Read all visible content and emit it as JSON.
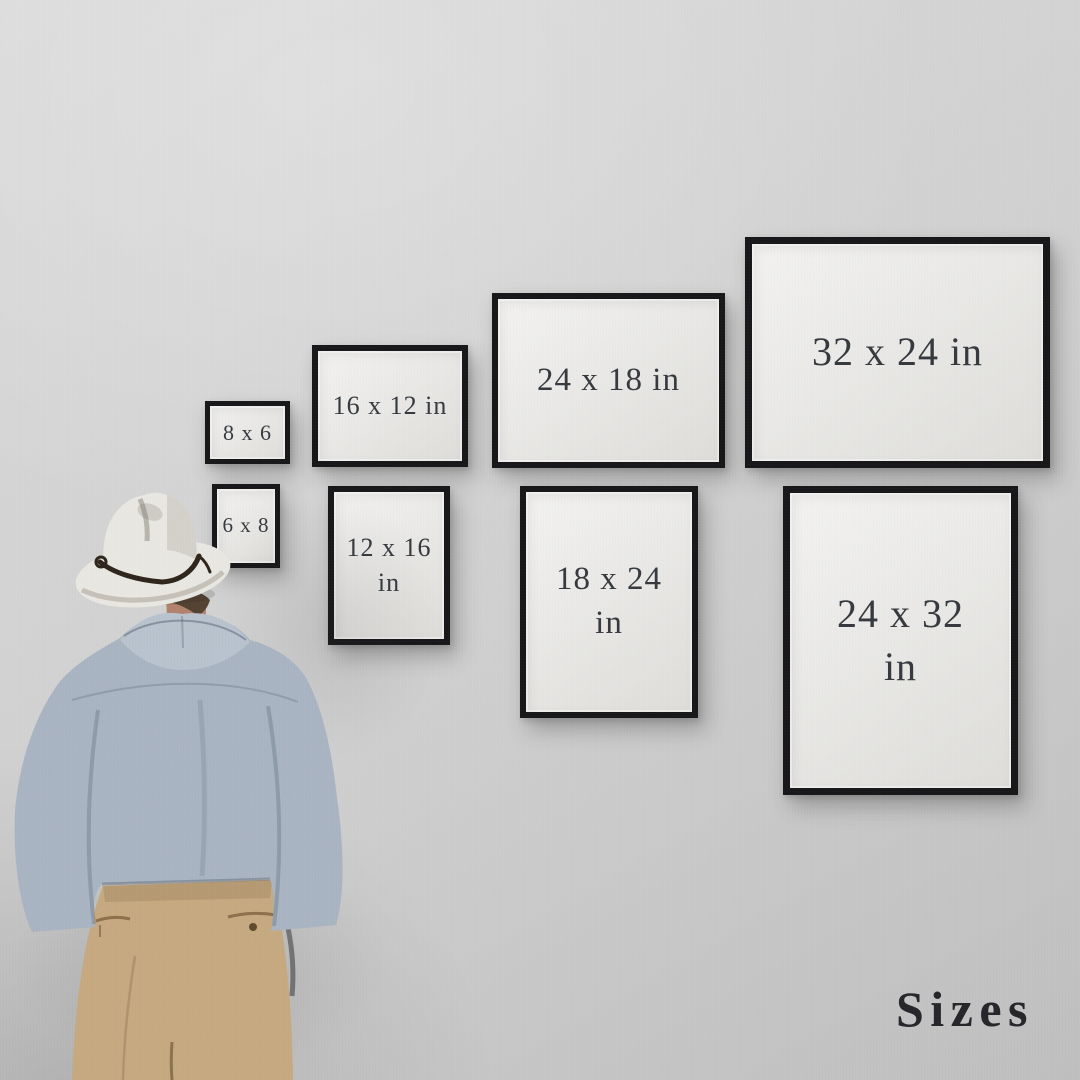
{
  "title": {
    "label": "Sizes"
  },
  "colors": {
    "wall_top": "#dbdbdb",
    "wall_mid": "#d1d1d1",
    "wall_bottom": "#bfbfbf",
    "frame_border": "#141417",
    "frame_paper": "#ebeae7",
    "frame_text": "#33373c",
    "title_text": "#26262b",
    "hat": "#eae8e2",
    "hat_band": "#2b2219",
    "hair": "#51402f",
    "skin": "#b2816b",
    "shirt": "#a9b4c2",
    "collar": "#b9c3cf",
    "pants": "#c6a97f"
  },
  "frames": [
    {
      "id": "frame-8x6",
      "label": "8 x 6",
      "width_in": 8,
      "height_in": 6,
      "orientation": "landscape",
      "row": "top"
    },
    {
      "id": "frame-16x12",
      "label": "16 x 12 in",
      "width_in": 16,
      "height_in": 12,
      "orientation": "landscape",
      "row": "top"
    },
    {
      "id": "frame-24x18",
      "label": "24 x 18 in",
      "width_in": 24,
      "height_in": 18,
      "orientation": "landscape",
      "row": "top"
    },
    {
      "id": "frame-32x24",
      "label": "32 x 24 in",
      "width_in": 32,
      "height_in": 24,
      "orientation": "landscape",
      "row": "top"
    },
    {
      "id": "frame-6x8",
      "label": "6 x 8",
      "width_in": 6,
      "height_in": 8,
      "orientation": "portrait",
      "row": "bottom"
    },
    {
      "id": "frame-12x16",
      "label": "12 x 16 in",
      "width_in": 12,
      "height_in": 16,
      "orientation": "portrait",
      "row": "bottom"
    },
    {
      "id": "frame-18x24",
      "label": "18 x 24 in",
      "width_in": 18,
      "height_in": 24,
      "orientation": "portrait",
      "row": "bottom"
    },
    {
      "id": "frame-24x32",
      "label": "24 x 32 in",
      "width_in": 24,
      "height_in": 32,
      "orientation": "portrait",
      "row": "bottom"
    }
  ]
}
